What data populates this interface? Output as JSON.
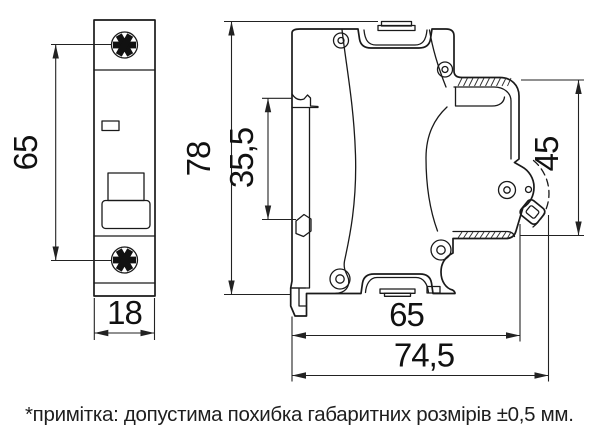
{
  "drawing": {
    "type": "circuit-breaker dimensional drawing",
    "views": {
      "front": "front view (1-pole modular breaker)",
      "side": "side view (DIN-rail profile)"
    }
  },
  "dimensions": {
    "mounting_holes": "65",
    "width": "18",
    "height": "78",
    "rail_claw_span": "35,5",
    "front_panel": "45",
    "depth_body": "65",
    "depth_total": "74,5"
  },
  "note": "*примітка: допустима похибка габаритних розмірів ±0,5 мм.",
  "colors": {
    "line": "#1a1a1a",
    "dimension": "#222222",
    "background": "#ffffff",
    "screw_fill": "#111111"
  }
}
